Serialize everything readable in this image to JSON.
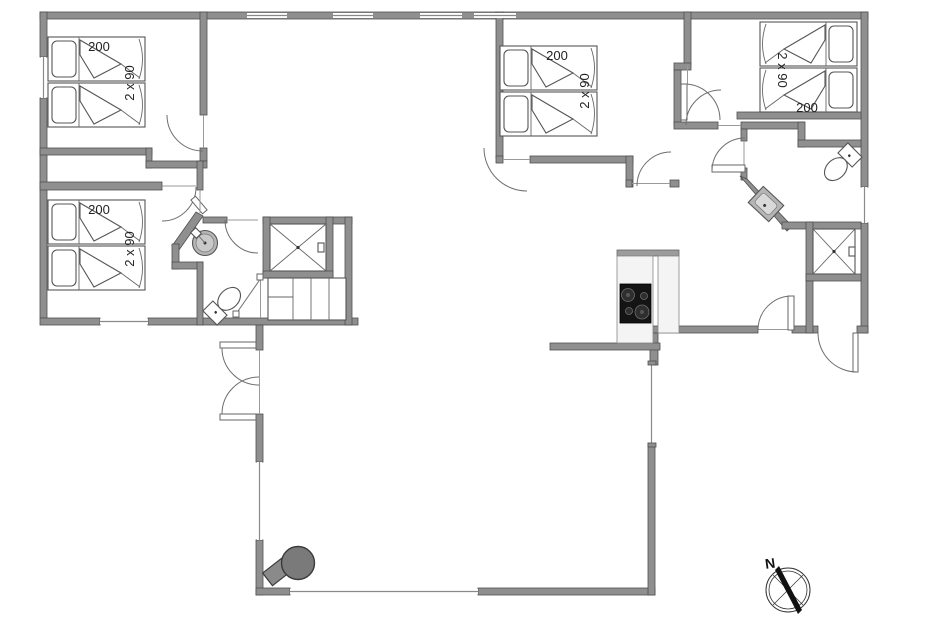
{
  "page": {
    "background": "#ffffff",
    "type": "holiday-house-floor-plan"
  },
  "colors": {
    "wall": "#8f8f8f",
    "wall_outline": "#4f4f4f",
    "thin_line": "#8a8a8a",
    "fixture_outline": "#555555",
    "cooktop": "#141414",
    "wood_stove": "#7a7a7a",
    "sink": "#b5b5b5",
    "counter": "#f4f4f4",
    "counter_edge": "#9c9c9c",
    "text": "#222222"
  },
  "rooms": {
    "bedroom_top_left": {
      "bed_length": "200",
      "bed_size": "2 x 90"
    },
    "bedroom_bottom_left": {
      "bed_length": "200",
      "bed_size": "2 x 90"
    },
    "bedroom_middle": {
      "bed_length": "200",
      "bed_size": "2 x 90"
    },
    "bedroom_top_right": {
      "bed_length": "200",
      "bed_size": "2 x 90"
    }
  },
  "compass": {
    "north": "N"
  },
  "fixtures": {
    "icons": [
      "bed-icon",
      "pillow-icon",
      "duvet-icon",
      "shower-icon",
      "toilet-icon",
      "washbasin-icon",
      "stairs-icon",
      "cooktop-icon",
      "wood-stove-icon",
      "door-arc-icon",
      "window-icon",
      "compass-icon"
    ]
  }
}
